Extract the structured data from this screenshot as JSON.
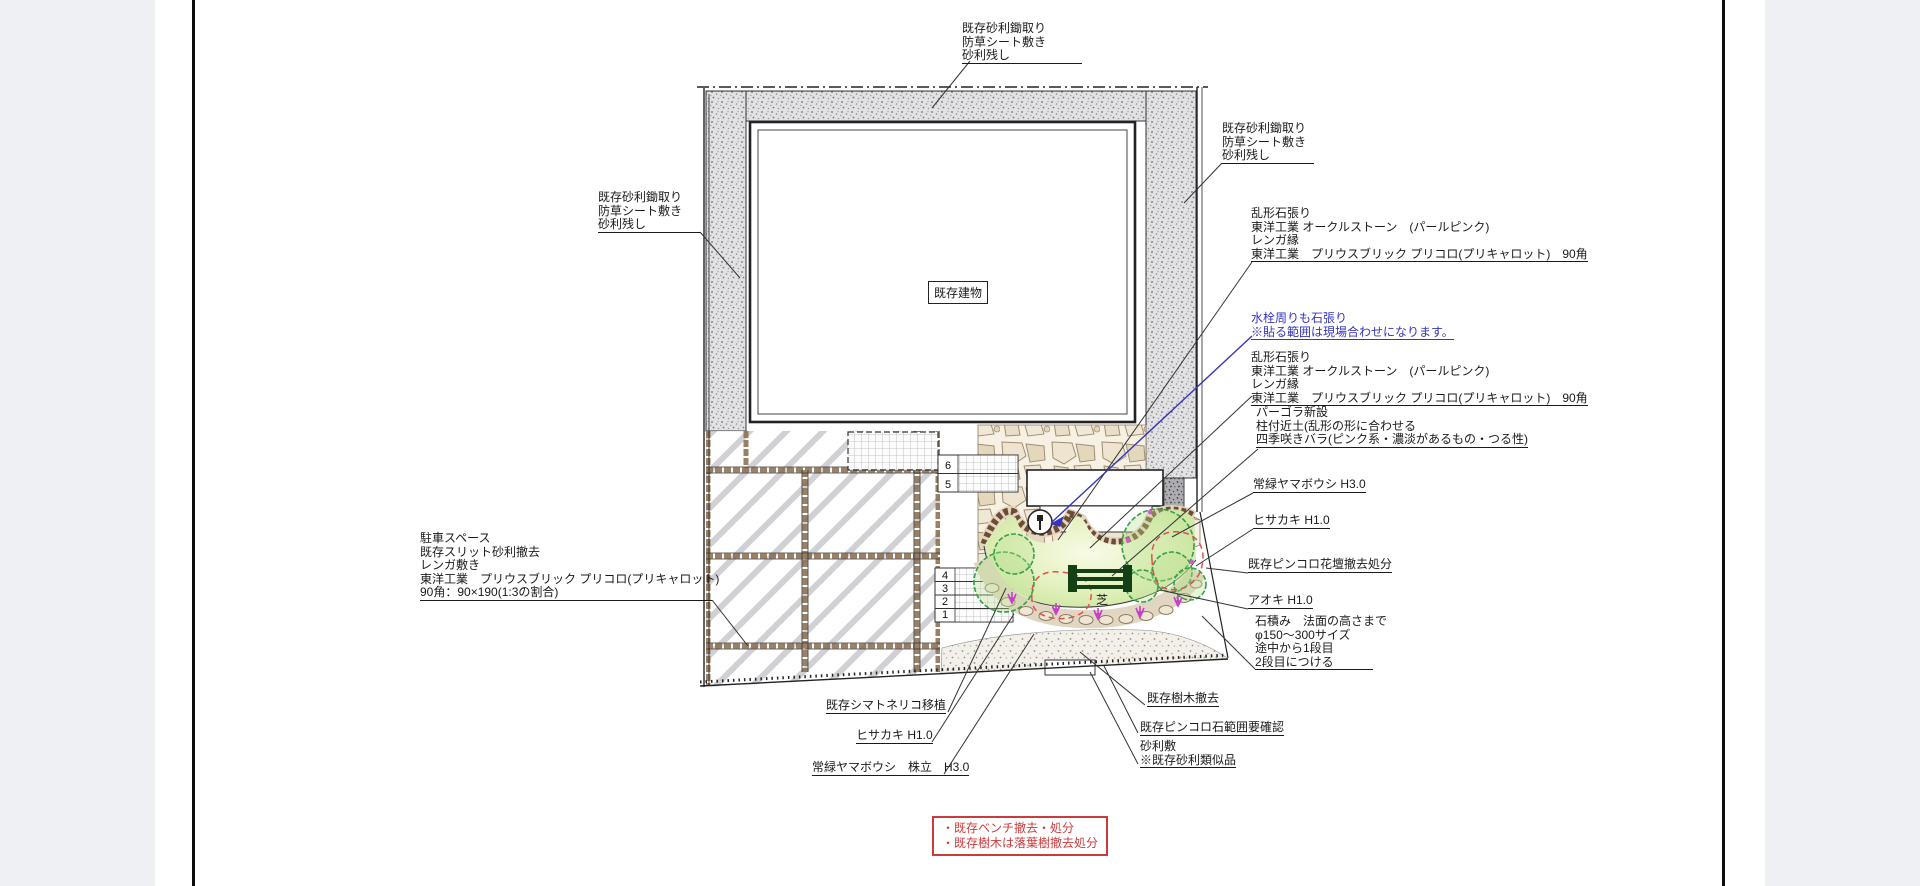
{
  "colors": {
    "accent_blue": "#3535bd",
    "note_red": "#cc3b3b"
  },
  "drawing": {
    "building_label": "既存建物",
    "lawn_label": "芝",
    "steps_upper": [
      "6",
      "5"
    ],
    "steps_lower": [
      "4",
      "3",
      "2",
      "1"
    ]
  },
  "annotations": {
    "gravel_top": {
      "lines": [
        "既存砂利鋤取り",
        "防草シート敷き",
        "砂利残し"
      ]
    },
    "gravel_right": {
      "lines": [
        "既存砂利鋤取り",
        "防草シート敷き",
        "砂利残し"
      ]
    },
    "gravel_left": {
      "lines": [
        "既存砂利鋤取り",
        "防草シート敷き",
        "砂利残し"
      ]
    },
    "stone_paving_upper": {
      "lines": [
        "乱形石張り",
        "東洋工業 オークルストーン　(パールピンク)",
        "レンガ縁",
        "東洋工業　プリウスブリック プリコロ(プリキャロット)　90角"
      ]
    },
    "faucet_note": {
      "lines": [
        "水栓周りも石張り",
        "※貼る範囲は現場合わせになります。"
      ]
    },
    "stone_paving_lower": {
      "lines": [
        "乱形石張り",
        "東洋工業 オークルストーン　(パールピンク)",
        "レンガ縁",
        "東洋工業　プリウスブリック プリコロ(プリキャロット)　90角"
      ]
    },
    "pergola": {
      "lines": [
        "パーゴラ新設",
        "柱付近土(乱形の形に合わせる",
        "四季咲きバラ(ピンク系・濃淡があるもの・つる性)"
      ]
    },
    "evergreen_dogwood_right": {
      "text": "常緑ヤマボウシ H3.0"
    },
    "hisakaki_right": {
      "text": "ヒサカキ H1.0"
    },
    "pincoro_flowerbed": {
      "text": "既存ピンコロ花壇撤去処分"
    },
    "aoki": {
      "text": "アオキ H1.0"
    },
    "stone_piling": {
      "lines": [
        "石積み　法面の高さまで",
        "φ150～300サイズ",
        "途中から1段目",
        "2段目につける"
      ]
    },
    "parking": {
      "lines": [
        "駐車スペース",
        "既存スリット砂利撤去",
        "レンガ敷き",
        "東洋工業　プリウスブリック プリコロ(プリキャロット)",
        "90角：90×190(1:3の割合)"
      ]
    },
    "shimatoneriko": {
      "text": "既存シマトネリコ移植"
    },
    "hisakaki_bottom": {
      "text": "ヒサカキ H1.0"
    },
    "evergreen_dogwood_bottom": {
      "text": "常緑ヤマボウシ　株立　H3.0"
    },
    "tree_removal": {
      "text": "既存樹木撤去"
    },
    "pincoro_range": {
      "text": "既存ピンコロ石範囲要確認"
    },
    "gravel_laying": {
      "lines": [
        "砂利敷",
        "※既存砂利類似品"
      ]
    },
    "note_box": {
      "lines": [
        "・既存ベンチ撤去・処分",
        "・既存樹木は落葉樹撤去処分"
      ]
    }
  }
}
